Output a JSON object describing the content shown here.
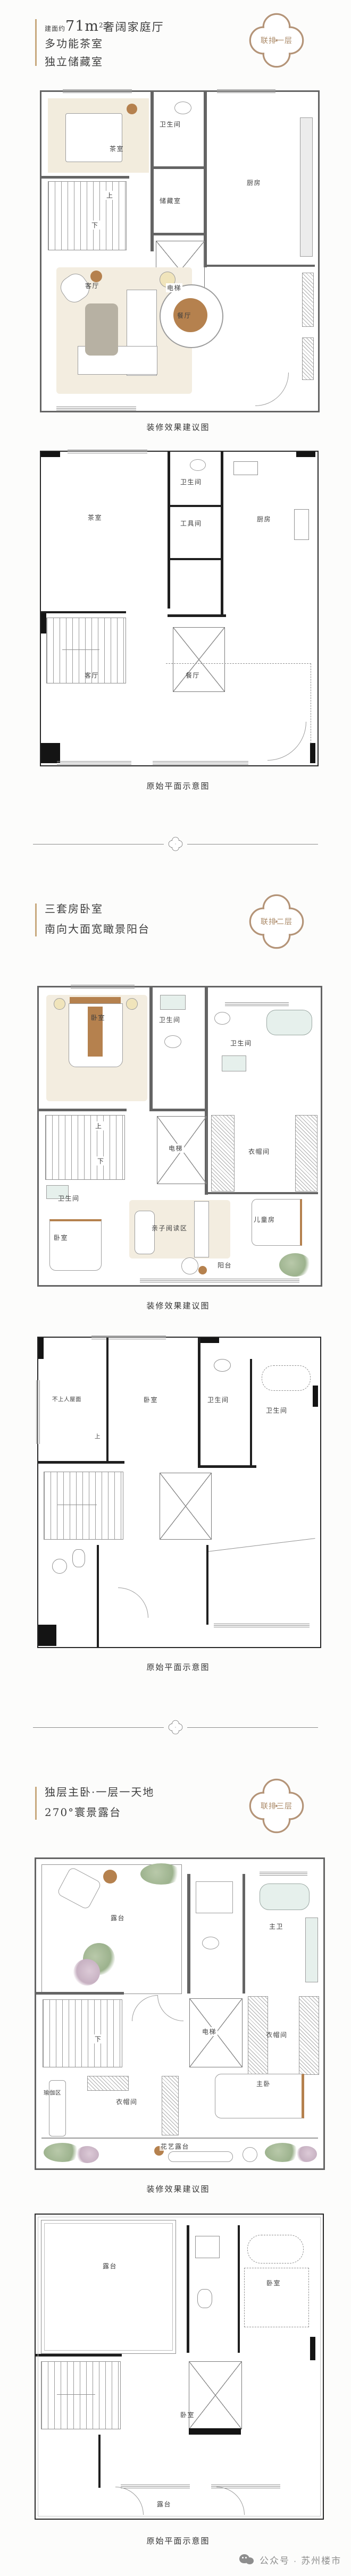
{
  "captions": {
    "decorated": "装修效果建议图",
    "original": "原始平面示意图"
  },
  "footer": {
    "label": "公众号 · 苏州楼市",
    "icon": "wechat-icon"
  },
  "colors": {
    "accent_tan": "#b49478",
    "bar_tan": "#c8a97e",
    "text_dark": "#3d3d3d",
    "footer_gray": "#8e8e8e",
    "wood": "#b5814e",
    "beige": "#f2ecdd"
  },
  "sections": [
    {
      "badge": "联排一层",
      "headline": {
        "prefix": "建面约",
        "area": "71m",
        "sup": "2",
        "suffix": "奢阔家庭厅"
      },
      "features": [
        "多功能茶室",
        "独立储藏室"
      ],
      "dec": {
        "tea": "茶室",
        "bath": "卫生间",
        "storage": "储藏室",
        "kitchen": "厨房",
        "lift": "电梯",
        "up": "上",
        "down": "下",
        "living": "客厅",
        "dining": "餐厅"
      },
      "orig": {
        "tea": "茶室",
        "bath": "卫生间",
        "tool": "工具间",
        "kitchen": "厨房",
        "living": "客厅",
        "dining": "餐厅"
      }
    },
    {
      "badge": "联排二层",
      "features": [
        "三套房卧室",
        "南向大面宽瞰景阳台"
      ],
      "dec": {
        "bedroom": "卧室",
        "bath_a": "卫生间",
        "bath_b": "卫生间",
        "lift": "电梯",
        "cloak": "衣帽间",
        "up": "上",
        "down": "下",
        "bath_c": "卫生间",
        "bedroom_b": "卧室",
        "reading": "亲子阅读区",
        "kids": "儿童房",
        "balcony": "阳台"
      },
      "orig": {
        "roof": "不上人屋面",
        "bedroom": "卧室",
        "bath_a": "卫生间",
        "bath_b": "卫生间",
        "up": "上"
      }
    },
    {
      "badge": "联排三层",
      "features": [
        "独层主卧·一层一天地",
        "270°寰景露台"
      ],
      "dec": {
        "terrace": "露台",
        "master_bath": "主卫",
        "lift": "电梯",
        "cloak": "衣帽间",
        "down": "下",
        "yoga": "瑜伽区",
        "cloak_b": "衣帽间",
        "master": "主卧",
        "flower": "花艺露台"
      },
      "orig": {
        "terrace": "露台",
        "bedroom_a": "卧室",
        "bedroom_b": "卧室",
        "terrace_b": "露台"
      }
    }
  ]
}
